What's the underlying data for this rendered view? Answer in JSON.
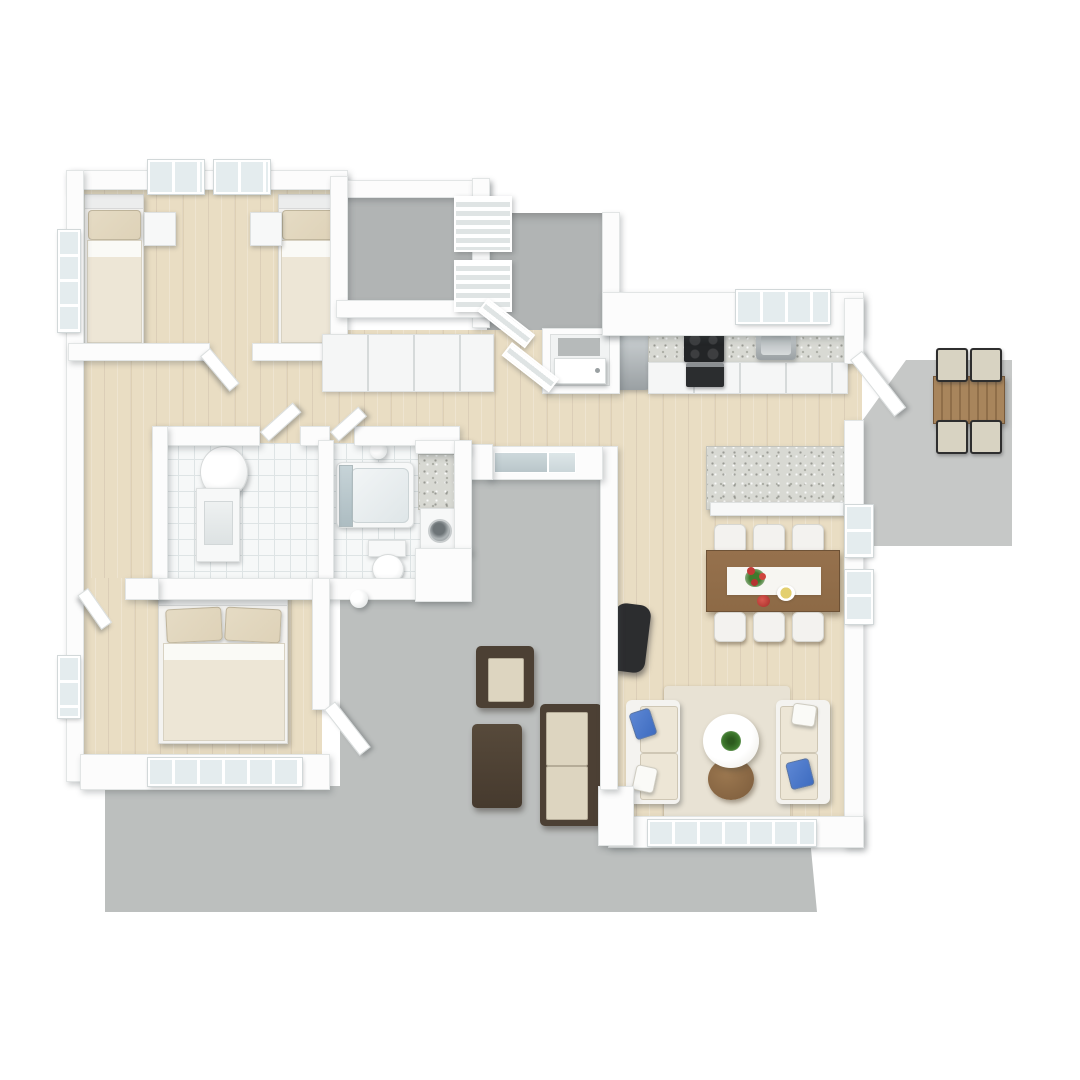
{
  "scene": {
    "description": "3D rendered residential floor plan, top-down dollhouse view on white background",
    "style": "photoreal 3D floorplan render, no text labels",
    "rooms": [
      {
        "id": "bedroom-twin",
        "label": "twin bedroom",
        "floor": "wood"
      },
      {
        "id": "storage-room",
        "label": "storage room",
        "floor": "gray-concrete"
      },
      {
        "id": "entry-porch",
        "label": "entry porch with railings and front door",
        "floor": "gray-concrete"
      },
      {
        "id": "hallway",
        "label": "hallway with wardrobe row",
        "floor": "wood"
      },
      {
        "id": "bathroom-shower",
        "label": "bathroom with round shower and vanity",
        "floor": "white-tile"
      },
      {
        "id": "bathroom-tub",
        "label": "bathroom with bathtub and toilet",
        "floor": "white-tile"
      },
      {
        "id": "laundry-nook",
        "label": "laundry nook with counter and washer",
        "floor": "tile"
      },
      {
        "id": "master-bedroom",
        "label": "master bedroom with double bed",
        "floor": "wood"
      },
      {
        "id": "kitchen",
        "label": "kitchen with counter, cooktop, sink, fridge",
        "floor": "wood"
      },
      {
        "id": "living-dining",
        "label": "open living and dining room",
        "floor": "wood"
      },
      {
        "id": "courtyard-patio",
        "label": "central patio with outdoor lounge set",
        "floor": "gray-concrete"
      },
      {
        "id": "side-patio",
        "label": "side patio with outdoor dining table",
        "floor": "gray-concrete"
      }
    ],
    "furniture": [
      {
        "room": "bedroom-twin",
        "items": [
          "twin bed",
          "twin bed",
          "nightstand",
          "nightstand"
        ]
      },
      {
        "room": "master-bedroom",
        "items": [
          "double bed with two pillows",
          "wall lamp"
        ]
      },
      {
        "room": "bathroom-shower",
        "items": [
          "round shower cylinder",
          "vanity with sink"
        ]
      },
      {
        "room": "bathroom-tub",
        "items": [
          "bathtub with glass panel",
          "toilet",
          "wall lamp"
        ]
      },
      {
        "room": "laundry-nook",
        "items": [
          "granite counter",
          "washing machine"
        ]
      },
      {
        "room": "kitchen",
        "items": [
          "refrigerator",
          "granite counter",
          "cooktop",
          "oven",
          "sink",
          "window"
        ]
      },
      {
        "room": "living-dining",
        "items": [
          "kitchen island",
          "dining table with runner, flowers and plates",
          "6 white chairs",
          "black lounge chair",
          "2 beige sofas",
          "blue pillows",
          "white pillows",
          "round white coffee table with plant",
          "round brown side table",
          "area rug"
        ]
      },
      {
        "room": "courtyard-patio",
        "items": [
          "wicker armchair",
          "wicker coffee table",
          "wicker loveseat"
        ]
      },
      {
        "room": "side-patio",
        "items": [
          "wood dining table",
          "4 black-frame chairs"
        ]
      }
    ]
  },
  "palette": {
    "bg": "#ffffff",
    "wall": "#fcfcfc",
    "wallEdge": "#e2e5e5",
    "wood1": "#e9ddc3",
    "grayCourt": "#bcbfbe",
    "grayStorage": "#b1b4b4",
    "grayPatio": "#c6c8c7",
    "tile": "#f6f8f8",
    "tileLine": "#dee4e5",
    "granite": "#d8d9d3",
    "darkAppliance": "#232527",
    "cream": "#ede6d6",
    "linen": "#e5dbc4",
    "headboard": "#f4f3f0",
    "wicker": "#4c4034",
    "wickerCushion": "#ddd5c0",
    "tableWood": "#8d6a46",
    "patioWood": "#9c7850",
    "chairWhite": "#f3f2ef",
    "blue": "#3e6cc0",
    "rug": "#e8e2d4",
    "plant": "#3e7a2d",
    "red": "#c23a36",
    "glass": "#c9d5d9"
  }
}
